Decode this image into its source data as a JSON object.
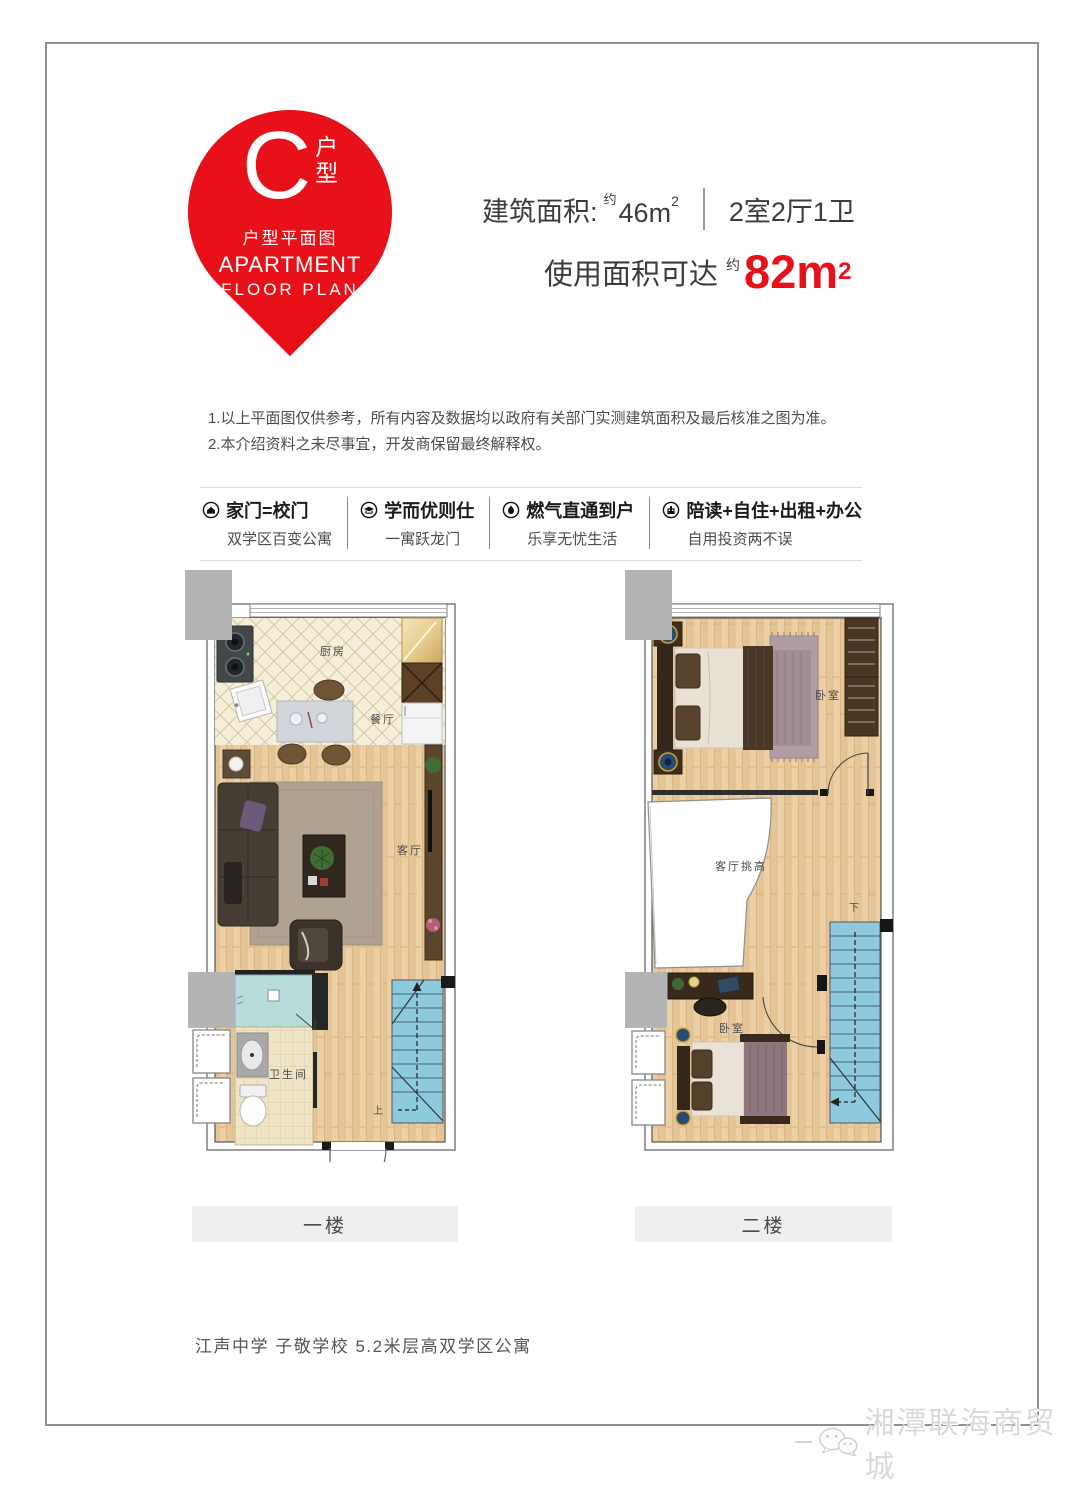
{
  "pin": {
    "letter": "C",
    "type_label_1": "户",
    "type_label_2": "型",
    "subtitle_cn": "户型平面图",
    "subtitle_en1": "APARTMENT",
    "subtitle_en2": "FLOOR PLAN"
  },
  "header": {
    "build_area_label": "建筑面积:",
    "build_area_approx": "约",
    "build_area_value": "46m",
    "build_area_sup": "2",
    "layout": "2室2厅1卫",
    "usable_label": "使用面积可达",
    "usable_approx": "约",
    "usable_value": "82m",
    "usable_sup": "2"
  },
  "disclaimer": {
    "line1": "1.以上平面图仅供参考，所有内容及数据均以政府有关部门实测建筑面积及最后核准之图为准。",
    "line2": "2.本介绍资料之未尽事宜，开发商保留最终解释权。"
  },
  "features": [
    {
      "icon": "school-gate-icon",
      "title": "家门=校门",
      "subtitle": "双学区百变公寓"
    },
    {
      "icon": "scholar-icon",
      "title": "学而优则仕",
      "subtitle": "一寓跃龙门"
    },
    {
      "icon": "flame-icon",
      "title": "燃气直通到户",
      "subtitle": "乐享无忧生活"
    },
    {
      "icon": "multi-use-icon",
      "title": "陪读+自住+出租+办公",
      "subtitle": "自用投资两不误"
    }
  ],
  "floor1": {
    "bar_label": "一楼",
    "kitchen": "厨房",
    "dining": "餐厅",
    "living": "客厅",
    "bathroom": "卫生间",
    "stairs_up": "上"
  },
  "floor2": {
    "bar_label": "二楼",
    "bedroom_top": "卧室",
    "void_label": "客厅挑高",
    "bedroom_bottom": "卧室",
    "stairs_down": "下"
  },
  "slogan": "江声中学 子敬学校 5.2米层高双学区公寓",
  "watermark": "湘潭联海商贸城",
  "colors": {
    "accent_red": "#e8111a",
    "stair_blue": "#8ecadd",
    "shaft_gray": "#b4b4b4",
    "wood": "#eccfa4",
    "kitchen_tile": "#f5eed9",
    "shower_teal": "#b8dcd9"
  }
}
